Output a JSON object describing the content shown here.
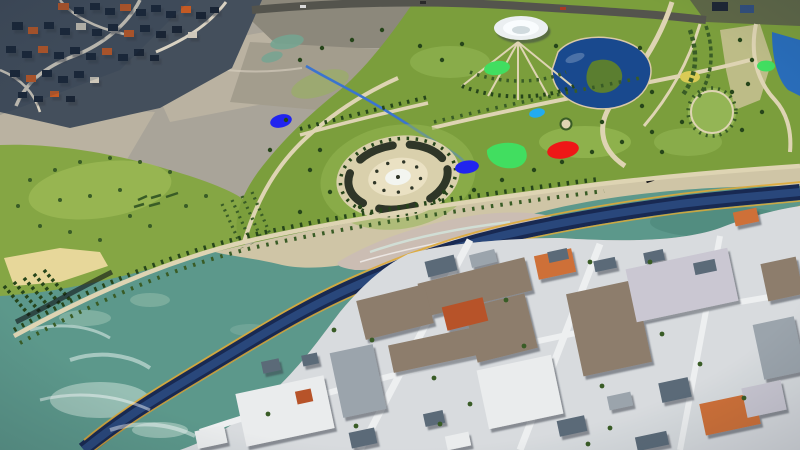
{
  "scene": {
    "title": "Riverfront park masterplan — aerial 3D render",
    "description": "Bird's-eye 3D visualization of a landscaped riverfront park with a lake, white dome pavilion, oval plaza, colored play areas and tree-lined promenades on the upper bank; a sinuous dark flood channel inside a wide teal river; a dense low-rise city district on the lower bank; barren hills and a hillside settlement in the upper left."
  },
  "features": [
    "hillside-settlement",
    "barren-hills",
    "wetland",
    "park-hill",
    "main-park",
    "lake",
    "lake-island",
    "dome-pavilion",
    "oval-plaza",
    "blue-pond",
    "blue-playfield",
    "green-playfield",
    "red-playfield",
    "cyan-pond",
    "yellow-flowerbed",
    "stream",
    "ring-garden",
    "roundabout",
    "orchard-rows",
    "vineyard-terraces",
    "riverside-promenade",
    "beach",
    "sediment-bar",
    "river",
    "flood-channel",
    "quay-lines",
    "city-district",
    "city-buildings",
    "top-road",
    "right-edge-pond"
  ],
  "palette": {
    "base": "#a8a399",
    "slopeLight": "#b8b1a1",
    "slopeMid": "#a29c8e",
    "slopeDark": "#8c887c",
    "settlement": "#46505c",
    "roofDark": "#1f2835",
    "roofOrange": "#bd5c2c",
    "roofTan": "#cdc7ba",
    "roadLight": "#d7d0c2",
    "roadDark": "#55554e",
    "hillGreen": "#86a44a",
    "hillGreenLight": "#a5bf63",
    "parkGreen": "#7c9d42",
    "parkGreenLight": "#95b35a",
    "lawnBright": "#9fbd60",
    "treeDark": "#29461e",
    "treeMid": "#3c5c2a",
    "wetland": "#75a492",
    "lakeBlue": "#1d4a8a",
    "pondBlue": "#2e6db4",
    "islandGreen": "#5d7d35",
    "domeWhite": "#e9edef",
    "domeInner": "#f7fafb",
    "path": "#dcd2b4",
    "plazaOuter": "#d7cead",
    "plazaInner": "#e7dfc3",
    "plazaCenter": "#f1f3ee",
    "plazaDark": "#31372a",
    "blobBlue": "#2427e2",
    "blobCyan": "#2aa9e9",
    "blobGreen": "#49da65",
    "blobRed": "#e21c1c",
    "blobYellow": "#d7c95c",
    "sand": "#d7c8a9",
    "sandLight": "#e4d59d",
    "sediment": "#c9bcb3",
    "river": "#5f978b",
    "riverLight": "#8fb7a9",
    "riverPale": "#d2e4dc",
    "riverDeep": "#497f73",
    "channel": "#1b2b51",
    "channelInner": "#2c4878",
    "channelEdge": "#d9a93f",
    "streamBlue": "#3f74c8",
    "cityGround": "#d6d9dc",
    "cityStreet": "#ebedee",
    "bTaupe": "#8c7d6d",
    "bLav": "#c8c6d0",
    "bOrange": "#c8713c",
    "bTerra": "#b1552e",
    "bSlate": "#5c6a77",
    "bGray": "#9ba3ab",
    "bWhite": "#e8eaeb",
    "foam": "#ffffff"
  }
}
